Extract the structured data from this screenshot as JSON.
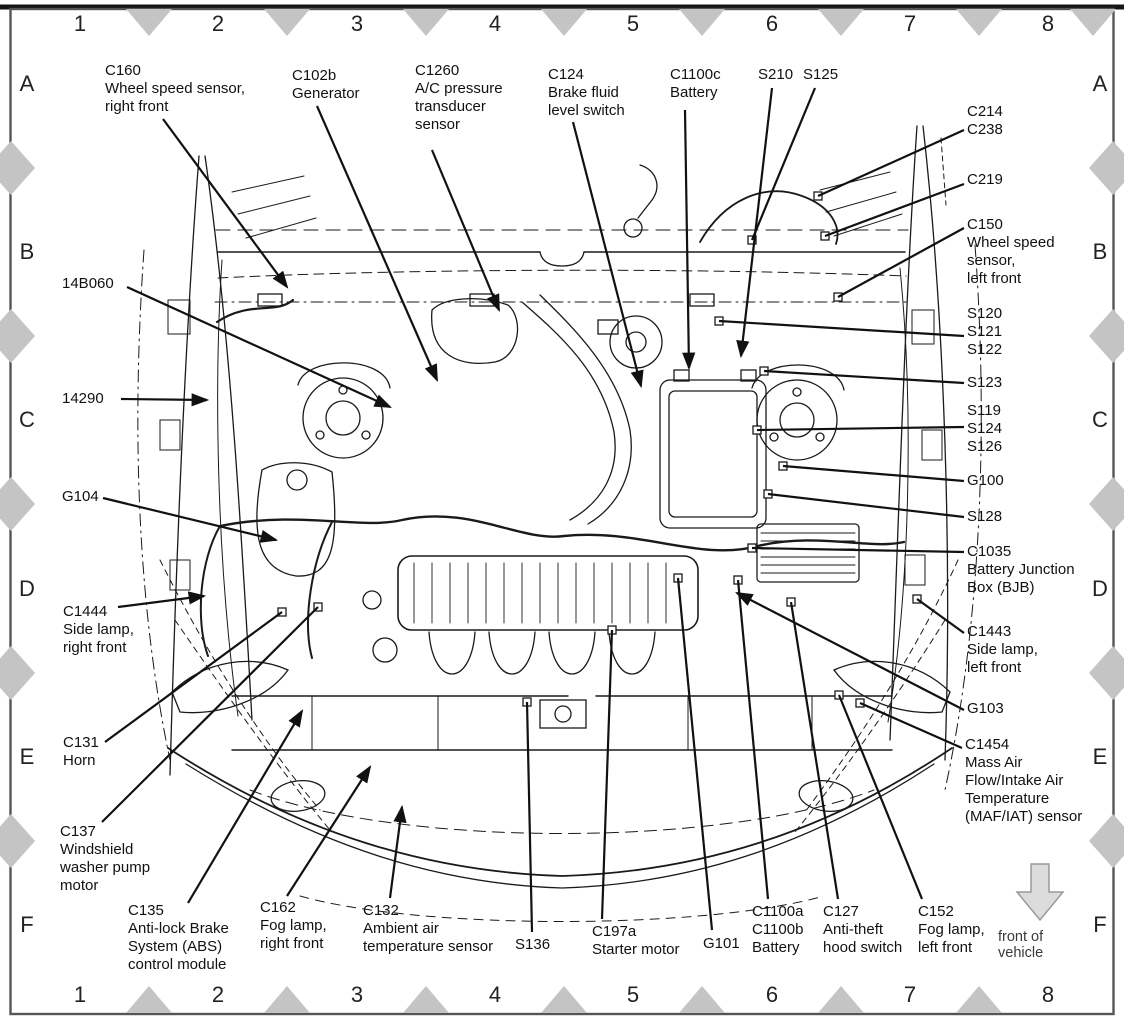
{
  "figure": {
    "ink_color": "#111111",
    "grid": {
      "marker_color": "#c4c4c4",
      "columns": [
        {
          "label": "1",
          "x": 80
        },
        {
          "label": "2",
          "x": 218
        },
        {
          "label": "3",
          "x": 357
        },
        {
          "label": "4",
          "x": 495
        },
        {
          "label": "5",
          "x": 633
        },
        {
          "label": "6",
          "x": 772
        },
        {
          "label": "7",
          "x": 910
        },
        {
          "label": "8",
          "x": 1048
        }
      ],
      "rows": [
        {
          "label": "A",
          "y": 84
        },
        {
          "label": "B",
          "y": 252
        },
        {
          "label": "C",
          "y": 420
        },
        {
          "label": "D",
          "y": 589
        },
        {
          "label": "E",
          "y": 757
        },
        {
          "label": "F",
          "y": 925
        }
      ],
      "top_marker_x": [
        149,
        287,
        426,
        564,
        702,
        841,
        979,
        1093
      ],
      "bottom_marker_x": [
        149,
        287,
        426,
        564,
        702,
        841,
        979
      ],
      "side_marker_y": [
        168,
        336,
        504,
        673,
        841
      ],
      "top_row_y": 24,
      "bottom_row_y": 995,
      "left_col_x": 27,
      "right_col_x": 1100
    },
    "front_of_vehicle": {
      "label": "front of vehicle",
      "x": 1040,
      "y": 929,
      "arrow_fill": "#dcdcdc",
      "arrow_outline": "#999999"
    },
    "callouts": [
      {
        "id": "C160",
        "x": 105,
        "y": 62,
        "lines": [
          "C160",
          "Wheel speed sensor,",
          "right front"
        ],
        "leader": [
          163,
          119,
          287,
          287
        ],
        "arrow": true
      },
      {
        "id": "C102b",
        "x": 292,
        "y": 67,
        "lines": [
          "C102b",
          "Generator"
        ],
        "leader": [
          317,
          106,
          437,
          380
        ],
        "arrow": true
      },
      {
        "id": "C1260",
        "x": 415,
        "y": 62,
        "lines": [
          "C1260",
          "A/C pressure",
          "transducer",
          "sensor"
        ],
        "leader": [
          432,
          150,
          499,
          310
        ],
        "arrow": true
      },
      {
        "id": "C124",
        "x": 548,
        "y": 66,
        "lines": [
          "C124",
          "Brake fluid",
          "level switch"
        ],
        "leader": [
          573,
          122,
          641,
          386
        ],
        "arrow": true
      },
      {
        "id": "C1100c",
        "x": 670,
        "y": 66,
        "lines": [
          "C1100c",
          "Battery"
        ],
        "leader": [
          685,
          110,
          689,
          368
        ],
        "arrow": true
      },
      {
        "id": "S210",
        "x": 758,
        "y": 66,
        "lines": [
          "S210"
        ],
        "leader": [
          772,
          88,
          741,
          356
        ],
        "arrow": true
      },
      {
        "id": "S125",
        "x": 803,
        "y": 66,
        "lines": [
          "S125"
        ],
        "leader": [
          815,
          88,
          752,
          240
        ],
        "arrow": false
      },
      {
        "id": "C214-C238",
        "x": 967,
        "y": 103,
        "lines": [
          "C214",
          "C238"
        ],
        "leader": [
          964,
          130,
          818,
          196
        ],
        "arrow": false
      },
      {
        "id": "C219",
        "x": 967,
        "y": 171,
        "lines": [
          "C219"
        ],
        "leader": [
          964,
          184,
          825,
          236
        ],
        "arrow": false
      },
      {
        "id": "C150",
        "x": 967,
        "y": 216,
        "lines": [
          "C150",
          "Wheel speed",
          "sensor,",
          "left front"
        ],
        "leader": [
          964,
          228,
          838,
          297
        ],
        "arrow": false
      },
      {
        "id": "S120-S121-S122",
        "x": 967,
        "y": 305,
        "lines": [
          "S120",
          "S121",
          "S122"
        ],
        "leader": [
          964,
          336,
          719,
          321
        ],
        "arrow": false
      },
      {
        "id": "S123",
        "x": 967,
        "y": 374,
        "lines": [
          "S123"
        ],
        "leader": [
          964,
          383,
          764,
          371
        ],
        "arrow": false
      },
      {
        "id": "S119-S124-S126",
        "x": 967,
        "y": 402,
        "lines": [
          "S119",
          "S124",
          "S126"
        ],
        "leader": [
          964,
          427,
          757,
          430
        ],
        "arrow": false
      },
      {
        "id": "G100",
        "x": 967,
        "y": 472,
        "lines": [
          "G100"
        ],
        "leader": [
          964,
          481,
          783,
          466
        ],
        "arrow": false
      },
      {
        "id": "S128",
        "x": 967,
        "y": 508,
        "lines": [
          "S128"
        ],
        "leader": [
          964,
          517,
          768,
          494
        ],
        "arrow": false
      },
      {
        "id": "C1035",
        "x": 967,
        "y": 543,
        "lines": [
          "C1035",
          "Battery Junction",
          "Box (BJB)"
        ],
        "leader": [
          964,
          552,
          752,
          548
        ],
        "arrow": false
      },
      {
        "id": "C1443",
        "x": 967,
        "y": 623,
        "lines": [
          "C1443",
          "Side lamp,",
          "left front"
        ],
        "leader": [
          964,
          633,
          917,
          599
        ],
        "arrow": false
      },
      {
        "id": "G103",
        "x": 967,
        "y": 700,
        "lines": [
          "G103"
        ],
        "leader": [
          964,
          710,
          737,
          593
        ],
        "arrow": true
      },
      {
        "id": "C1454",
        "x": 965,
        "y": 736,
        "lines": [
          "C1454",
          "Mass Air",
          "Flow/Intake Air",
          "Temperature",
          "(MAF/IAT) sensor"
        ],
        "leader": [
          962,
          748,
          860,
          703
        ],
        "arrow": false
      },
      {
        "id": "14B060",
        "x": 62,
        "y": 275,
        "lines": [
          "14B060"
        ],
        "leader": [
          127,
          287,
          390,
          407
        ],
        "arrow": true
      },
      {
        "id": "14290",
        "x": 62,
        "y": 390,
        "lines": [
          "14290"
        ],
        "leader": [
          121,
          399,
          207,
          400
        ],
        "arrow": true
      },
      {
        "id": "G104",
        "x": 62,
        "y": 488,
        "lines": [
          "G104"
        ],
        "leader": [
          103,
          498,
          276,
          540
        ],
        "arrow": true
      },
      {
        "id": "C1444",
        "x": 63,
        "y": 603,
        "lines": [
          "C1444",
          "Side lamp,",
          "right front"
        ],
        "leader": [
          118,
          607,
          204,
          596
        ],
        "arrow": true
      },
      {
        "id": "C131",
        "x": 63,
        "y": 734,
        "lines": [
          "C131",
          "Horn"
        ],
        "leader": [
          105,
          742,
          282,
          612
        ],
        "arrow": false
      },
      {
        "id": "C137",
        "x": 60,
        "y": 823,
        "lines": [
          "C137",
          "Windshield",
          "washer pump",
          "motor"
        ],
        "leader": [
          102,
          822,
          318,
          607
        ],
        "arrow": false
      },
      {
        "id": "C135",
        "x": 128,
        "y": 902,
        "lines": [
          "C135",
          "Anti-lock Brake",
          "System (ABS)",
          "control module"
        ],
        "leader": [
          188,
          903,
          302,
          711
        ],
        "arrow": true
      },
      {
        "id": "C162",
        "x": 260,
        "y": 899,
        "lines": [
          "C162",
          "Fog lamp,",
          "right front"
        ],
        "leader": [
          287,
          896,
          370,
          767
        ],
        "arrow": true
      },
      {
        "id": "C132",
        "x": 363,
        "y": 902,
        "lines": [
          "C132",
          "Ambient air",
          "temperature sensor"
        ],
        "leader": [
          390,
          898,
          402,
          807
        ],
        "arrow": true
      },
      {
        "id": "S136",
        "x": 515,
        "y": 936,
        "lines": [
          "S136"
        ],
        "leader": [
          532,
          932,
          527,
          702
        ],
        "arrow": false
      },
      {
        "id": "C197a",
        "x": 592,
        "y": 923,
        "lines": [
          "C197a",
          "Starter motor"
        ],
        "leader": [
          602,
          919,
          612,
          630
        ],
        "arrow": false
      },
      {
        "id": "G101",
        "x": 703,
        "y": 935,
        "lines": [
          "G101"
        ],
        "leader": [
          712,
          930,
          678,
          578
        ],
        "arrow": false
      },
      {
        "id": "C1100a-C1100b",
        "x": 752,
        "y": 903,
        "lines": [
          "C1100a",
          "C1100b",
          "Battery"
        ],
        "leader": [
          768,
          899,
          738,
          580
        ],
        "arrow": false
      },
      {
        "id": "C127",
        "x": 823,
        "y": 903,
        "lines": [
          "C127",
          "Anti-theft",
          "hood switch"
        ],
        "leader": [
          838,
          899,
          791,
          602
        ],
        "arrow": false
      },
      {
        "id": "C152",
        "x": 918,
        "y": 903,
        "lines": [
          "C152",
          "Fog lamp,",
          "left front"
        ],
        "leader": [
          922,
          899,
          839,
          695
        ],
        "arrow": false
      }
    ]
  }
}
